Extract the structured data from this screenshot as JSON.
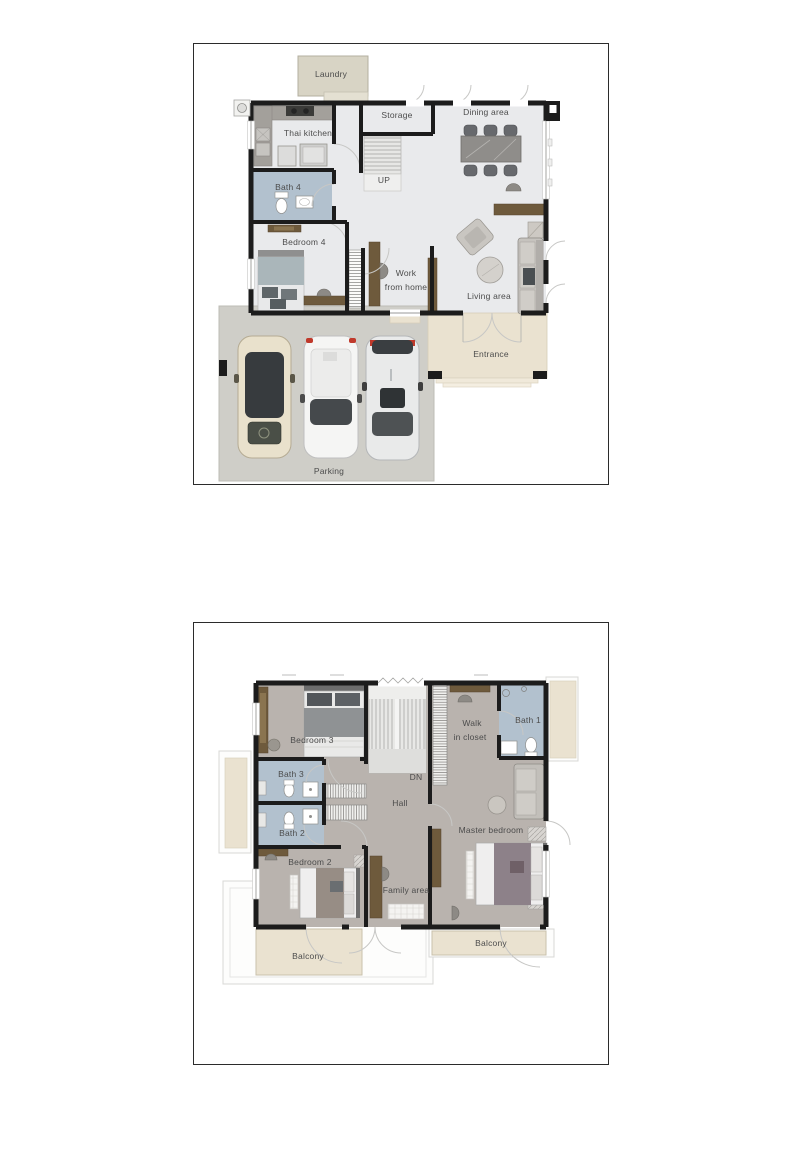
{
  "colors": {
    "wall": "#1c1c1c",
    "floor1_floor": "#e9eaec",
    "floor2_floor": "#b9b3ae",
    "bath_blue": "#b2c1ce",
    "marble_beige": "#eae2d0",
    "parking_concrete": "#cfcec8",
    "laundry_beige": "#d8d4c5",
    "wood_brown": "#6e5a3c",
    "label_text": "#4c4c4c"
  },
  "floor1": {
    "labels": {
      "laundry": "Laundry",
      "storage": "Storage",
      "thai_kitchen": "Thai kitchen",
      "dining_area": "Dining area",
      "up": "UP",
      "bath4": "Bath 4",
      "bedroom4": "Bedroom 4",
      "work_line1": "Work",
      "work_line2": "from home",
      "living_area": "Living area",
      "entrance": "Entrance",
      "parking": "Parking"
    }
  },
  "floor2": {
    "labels": {
      "bedroom3": "Bedroom 3",
      "bath3": "Bath 3",
      "bath2": "Bath 2",
      "bedroom2": "Bedroom 2",
      "dn": "DN",
      "hall": "Hall",
      "walk_line1": "Walk",
      "walk_line2": "in closet",
      "bath1": "Bath 1",
      "master_bedroom": "Master bedroom",
      "family_area": "Family area",
      "balcony_left": "Balcony",
      "balcony_right": "Balcony"
    }
  }
}
